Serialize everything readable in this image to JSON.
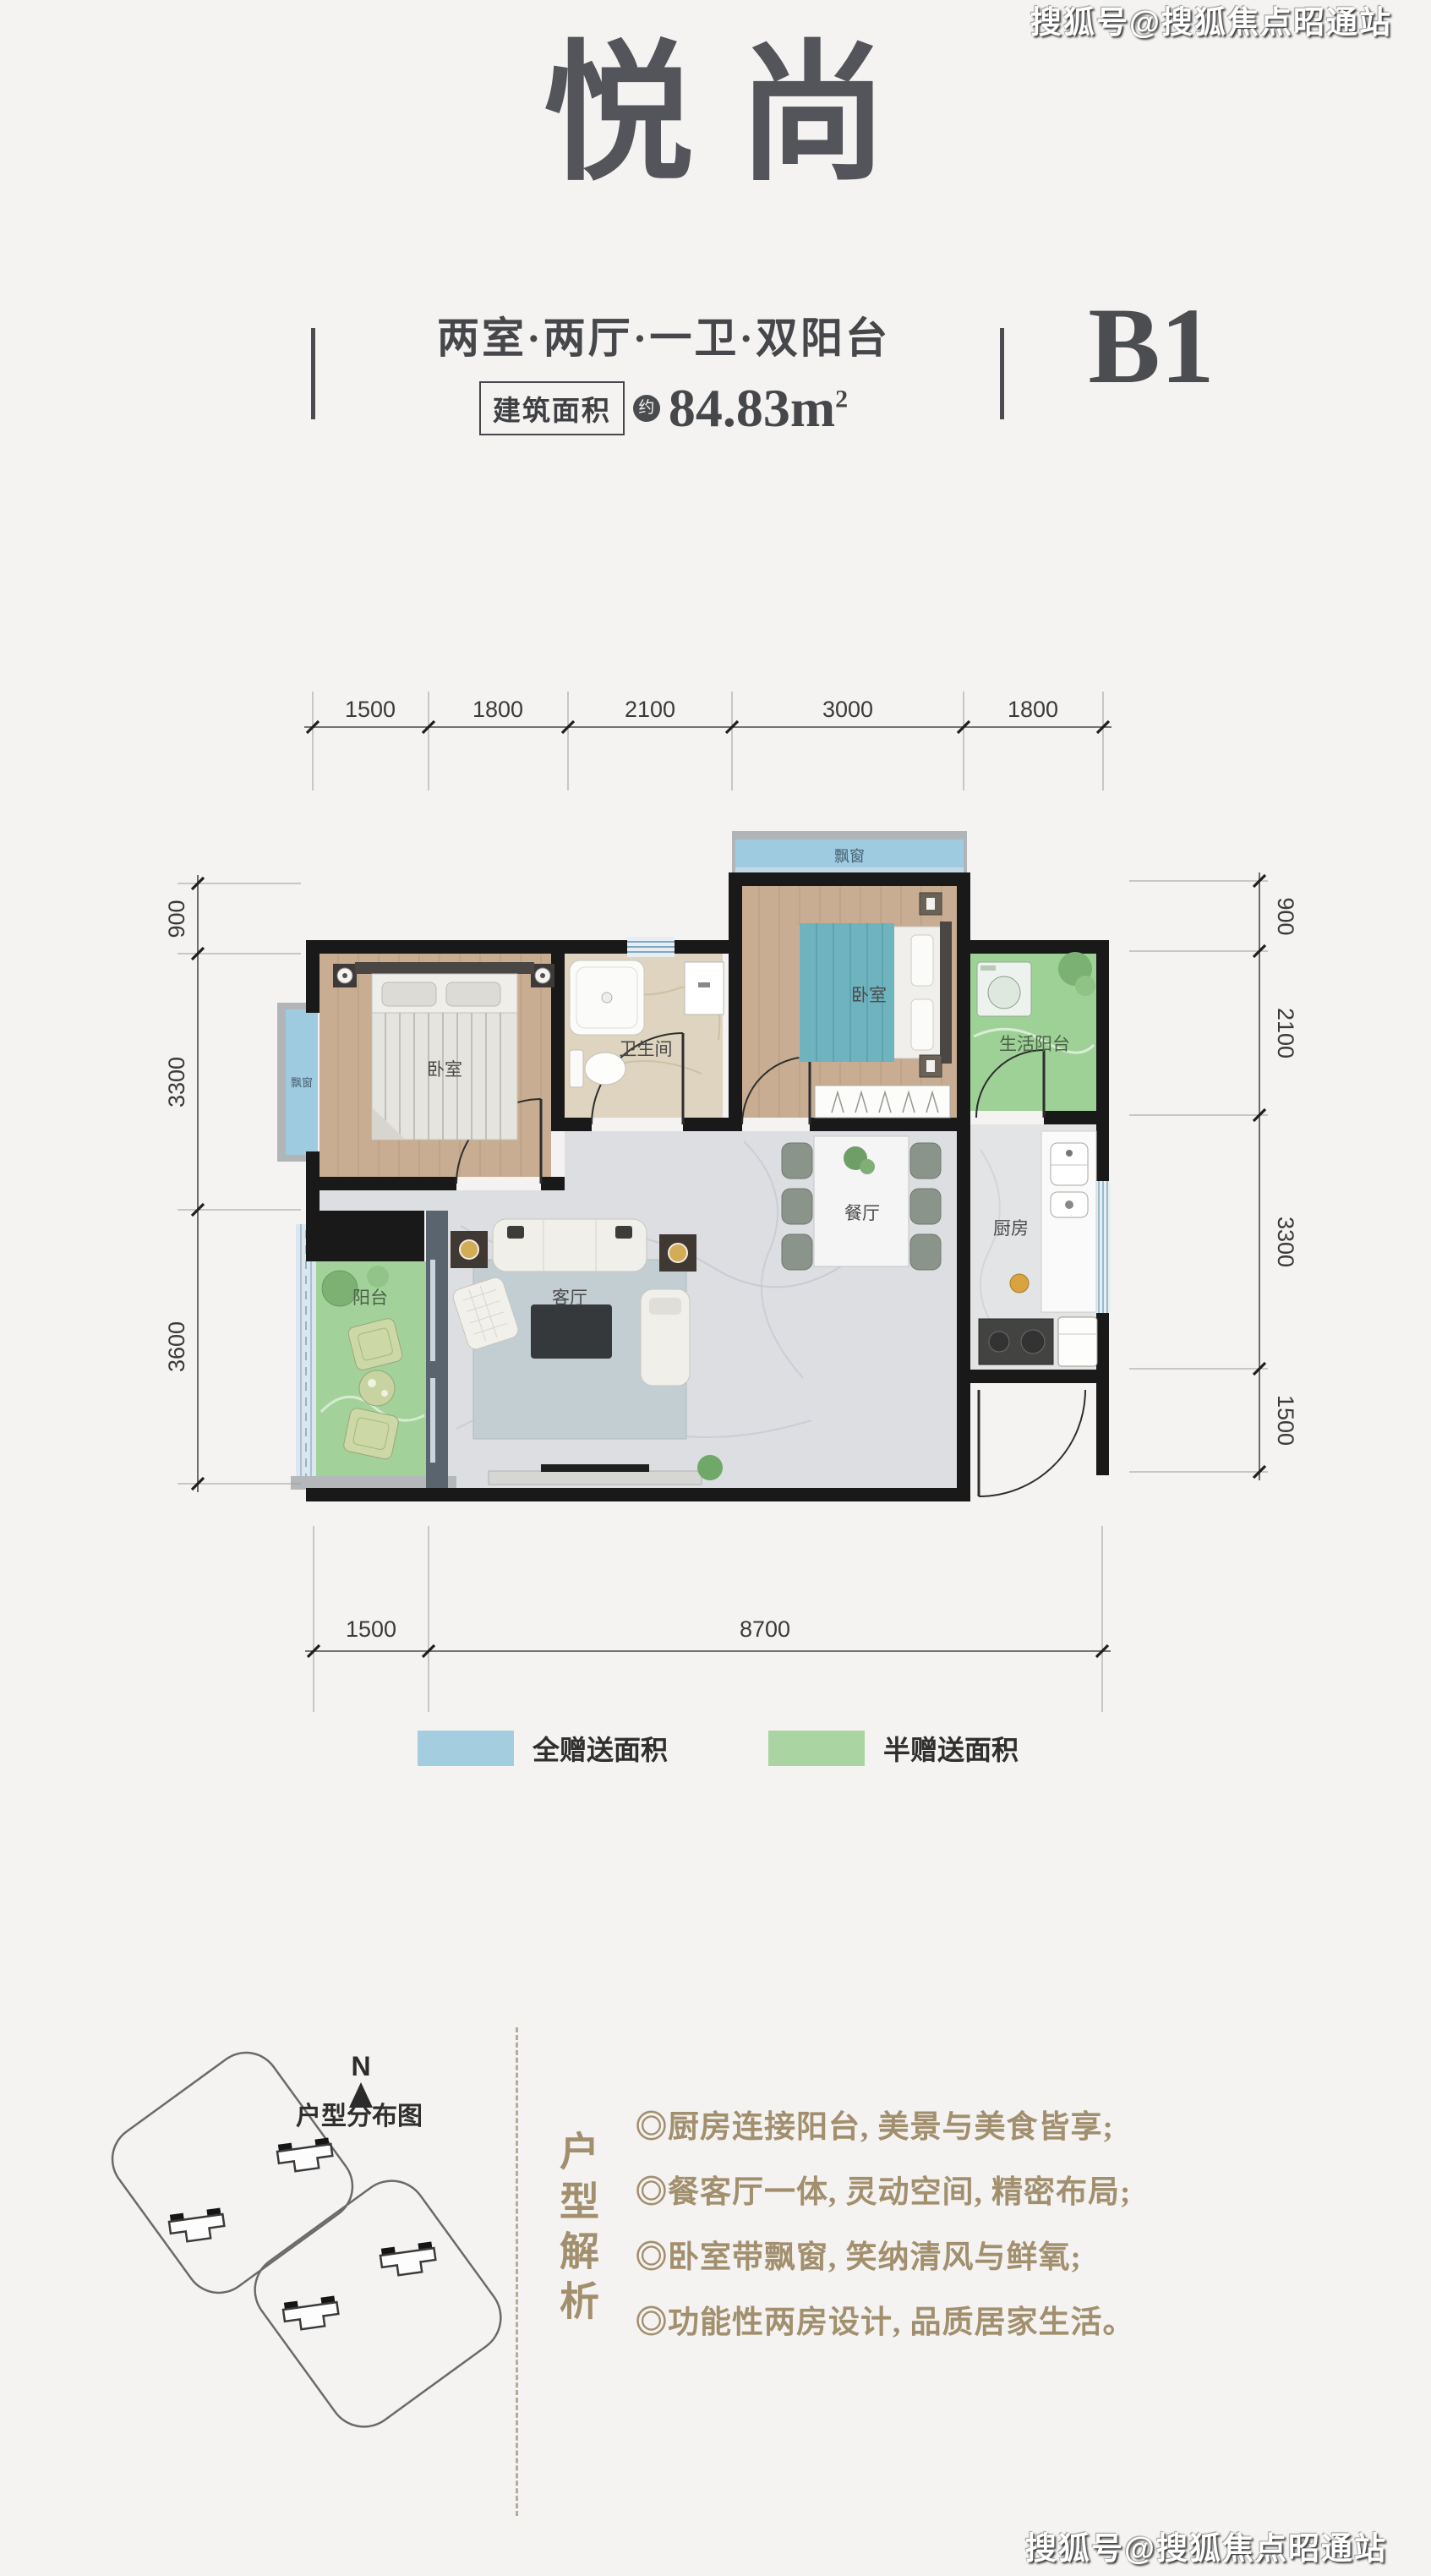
{
  "watermark": {
    "text": "搜狐号@搜狐焦点昭通站"
  },
  "header": {
    "title": "悦尚",
    "layout_desc": "两室·两厅·一卫·双阳台",
    "area_label": "建筑面积",
    "area_approx": "约",
    "area_value": "84.83m",
    "area_sup": "2",
    "unit_code": "B1"
  },
  "floorplan": {
    "rooms": {
      "bedroom1": "卧室",
      "bathroom": "卫生间",
      "bedroom2": "卧室",
      "life_balcony": "生活阳台",
      "dining": "餐厅",
      "kitchen": "厨房",
      "living": "客厅",
      "balcony": "阳台",
      "bay_window_top": "飘窗",
      "bay_window_left": "飘窗"
    },
    "dimensions": {
      "top": [
        "1500",
        "1800",
        "2100",
        "3000",
        "1800"
      ],
      "left": [
        "900",
        "3300",
        "3600"
      ],
      "right": [
        "900",
        "2100",
        "3300",
        "1500"
      ],
      "bottom": [
        "1500",
        "8700"
      ]
    }
  },
  "legend": {
    "items": [
      {
        "label": "全赠送面积",
        "color": "#a5cde0"
      },
      {
        "label": "半赠送面积",
        "color": "#aad4a1"
      }
    ]
  },
  "site_map": {
    "compass": "N",
    "caption": "户型分布图"
  },
  "analysis": {
    "title": "户型解析",
    "bullets": [
      "◎厨房连接阳台, 美景与美食皆享;",
      "◎餐客厅一体, 灵动空间, 精密布局;",
      "◎卧室带飘窗, 笑纳清风与鲜氧;",
      "◎功能性两房设计, 品质居家生活。"
    ]
  },
  "colors": {
    "accent_text": "#a28f6e",
    "wall": "#191919"
  }
}
